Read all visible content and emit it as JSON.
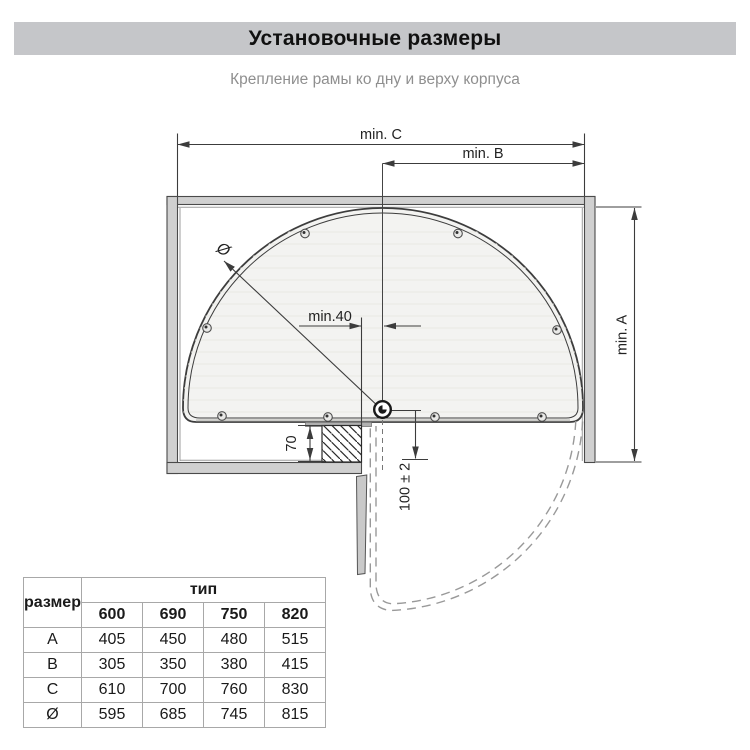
{
  "header": {
    "title": "Установочные размеры",
    "subtitle": "Крепление рамы ко дну и верху корпуса"
  },
  "diagram": {
    "dim_c": "min. C",
    "dim_b": "min. B",
    "dim_a": "min. A",
    "dim_40": "min.40",
    "dim_70": "70",
    "dim_100": "100 ± 2",
    "diameter_symbol": "Ø"
  },
  "table": {
    "size_header": "размер",
    "type_header": "тип",
    "types": [
      "600",
      "690",
      "750",
      "820"
    ],
    "rows": [
      {
        "label": "A",
        "values": [
          "405",
          "450",
          "480",
          "515"
        ]
      },
      {
        "label": "B",
        "values": [
          "305",
          "350",
          "380",
          "415"
        ]
      },
      {
        "label": "C",
        "values": [
          "610",
          "700",
          "760",
          "830"
        ]
      },
      {
        "label": "Ø",
        "values": [
          "595",
          "685",
          "745",
          "815"
        ]
      }
    ]
  },
  "colors": {
    "banner_bg": "#c5c6c9",
    "subtitle_text": "#8f8f8f",
    "line": "#3c3c3c",
    "wall_fill": "#d0d0d0",
    "shelf_fill": "#f3f3f1",
    "dashed_swing": "#999999"
  }
}
